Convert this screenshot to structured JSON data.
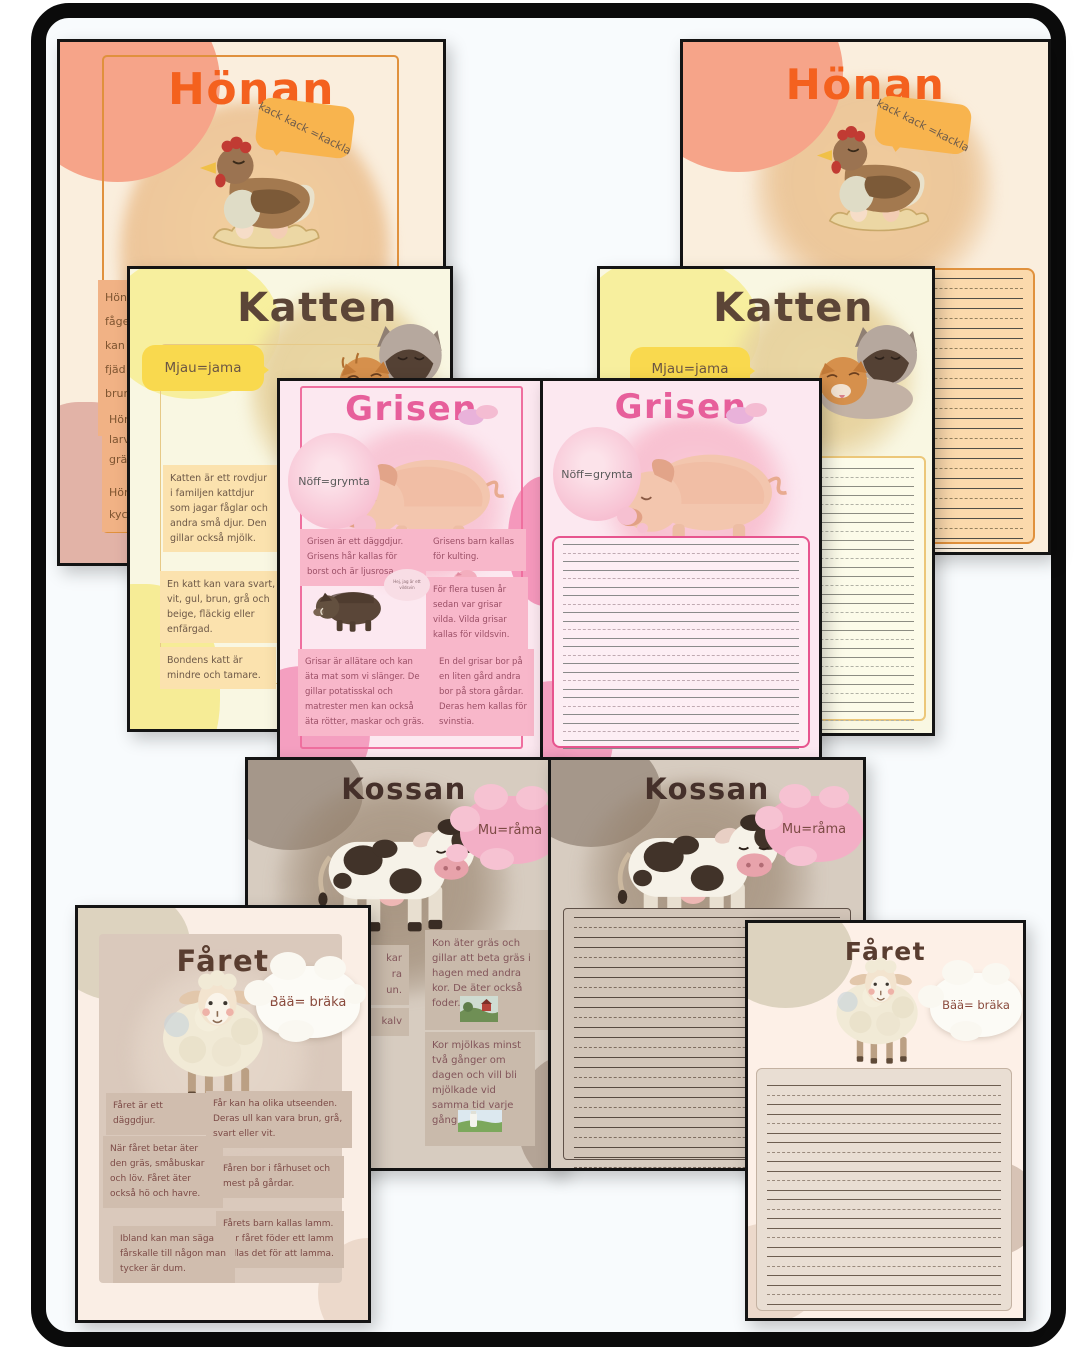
{
  "themes": {
    "honan_accent": "#f4611e",
    "katten_title": "#5c4537",
    "grisen_accent": "#e7609b",
    "kossan_title": "#45302a",
    "faret_title": "#593d30"
  },
  "honan_info": {
    "title": "Hönan",
    "bubble": "kack kack =kackla",
    "fragment1": "Höna\nfåge\nkan\nfjäd\nbrun\nvita.",
    "fragment2": "Hön\nlarv\ngrä",
    "fragment3": "Hön\nkyck"
  },
  "honan_write": {
    "title": "Hönan",
    "bubble": "kack kack =kackla"
  },
  "katten_info": {
    "title": "Katten",
    "bubble": "Mjau=jama",
    "block1": "Katten är ett rovdjur i familjen kattdjur som jagar fåglar och andra små djur. Den gillar också mjölk.",
    "block2": "En katt kan vara svart, vit, gul, brun, grå och beige, fläckig eller enfärgad.",
    "block3": "Bondens katt är mindre och tamare."
  },
  "katten_write": {
    "title": "Katten",
    "bubble": "Mjau=jama"
  },
  "grisen_info": {
    "title": "Grisen",
    "bubble": "Nöff=grymta",
    "boar_bubble": "Hej, jag är ett vildsvin",
    "block1": "Grisen är ett däggdjur. Grisens hår kallas för borst och är ljusrosa.",
    "block2": "Grisens barn kallas för kulting.",
    "block3": "För flera tusen år sedan var grisar vilda. Vilda grisar kallas för vildsvin.",
    "block4": "Grisar är allätare och kan äta mat som vi slänger. De gillar potatisskal och matrester men kan också äta rötter, maskar och gräs.",
    "block5": "En del grisar bor på en liten gård andra bor på stora gårdar. Deras hem kallas för svinstia."
  },
  "grisen_write": {
    "title": "Grisen",
    "bubble": "Nöff=grymta"
  },
  "kossan_info": {
    "title": "Kossan",
    "bubble": "Mu=råma",
    "fragment1": "kar\nra\nun.",
    "fragment2": "kalv",
    "block1": "Kon äter gräs och gillar att beta gräs i hagen med andra kor. De äter också foder.",
    "block2": "Kor mjölkas minst två gånger om dagen och vill bli mjölkade vid samma tid varje gång."
  },
  "kossan_write": {
    "title": "Kossan",
    "bubble": "Mu=råma"
  },
  "faret_info": {
    "title": "Fåret",
    "bubble": "Bää= bräka",
    "block1": "Fåret är ett däggdjur.",
    "block2": "Får kan ha olika utseenden. Deras ull kan vara brun, grå, svart eller vit.",
    "block3": "När fåret betar äter den gräs, småbuskar och löv. Fåret äter också hö och havre.",
    "block4": "Fåren bor i fårhuset och mest på gårdar.",
    "block5": "Ibland kan man säga fårskalle till någon man tycker är dum.",
    "block6": "Fårets barn kallas lamm. När fåret föder ett lamm kallas det för att lamma."
  },
  "faret_write": {
    "title": "Fåret",
    "bubble": "Bää= bräka"
  }
}
